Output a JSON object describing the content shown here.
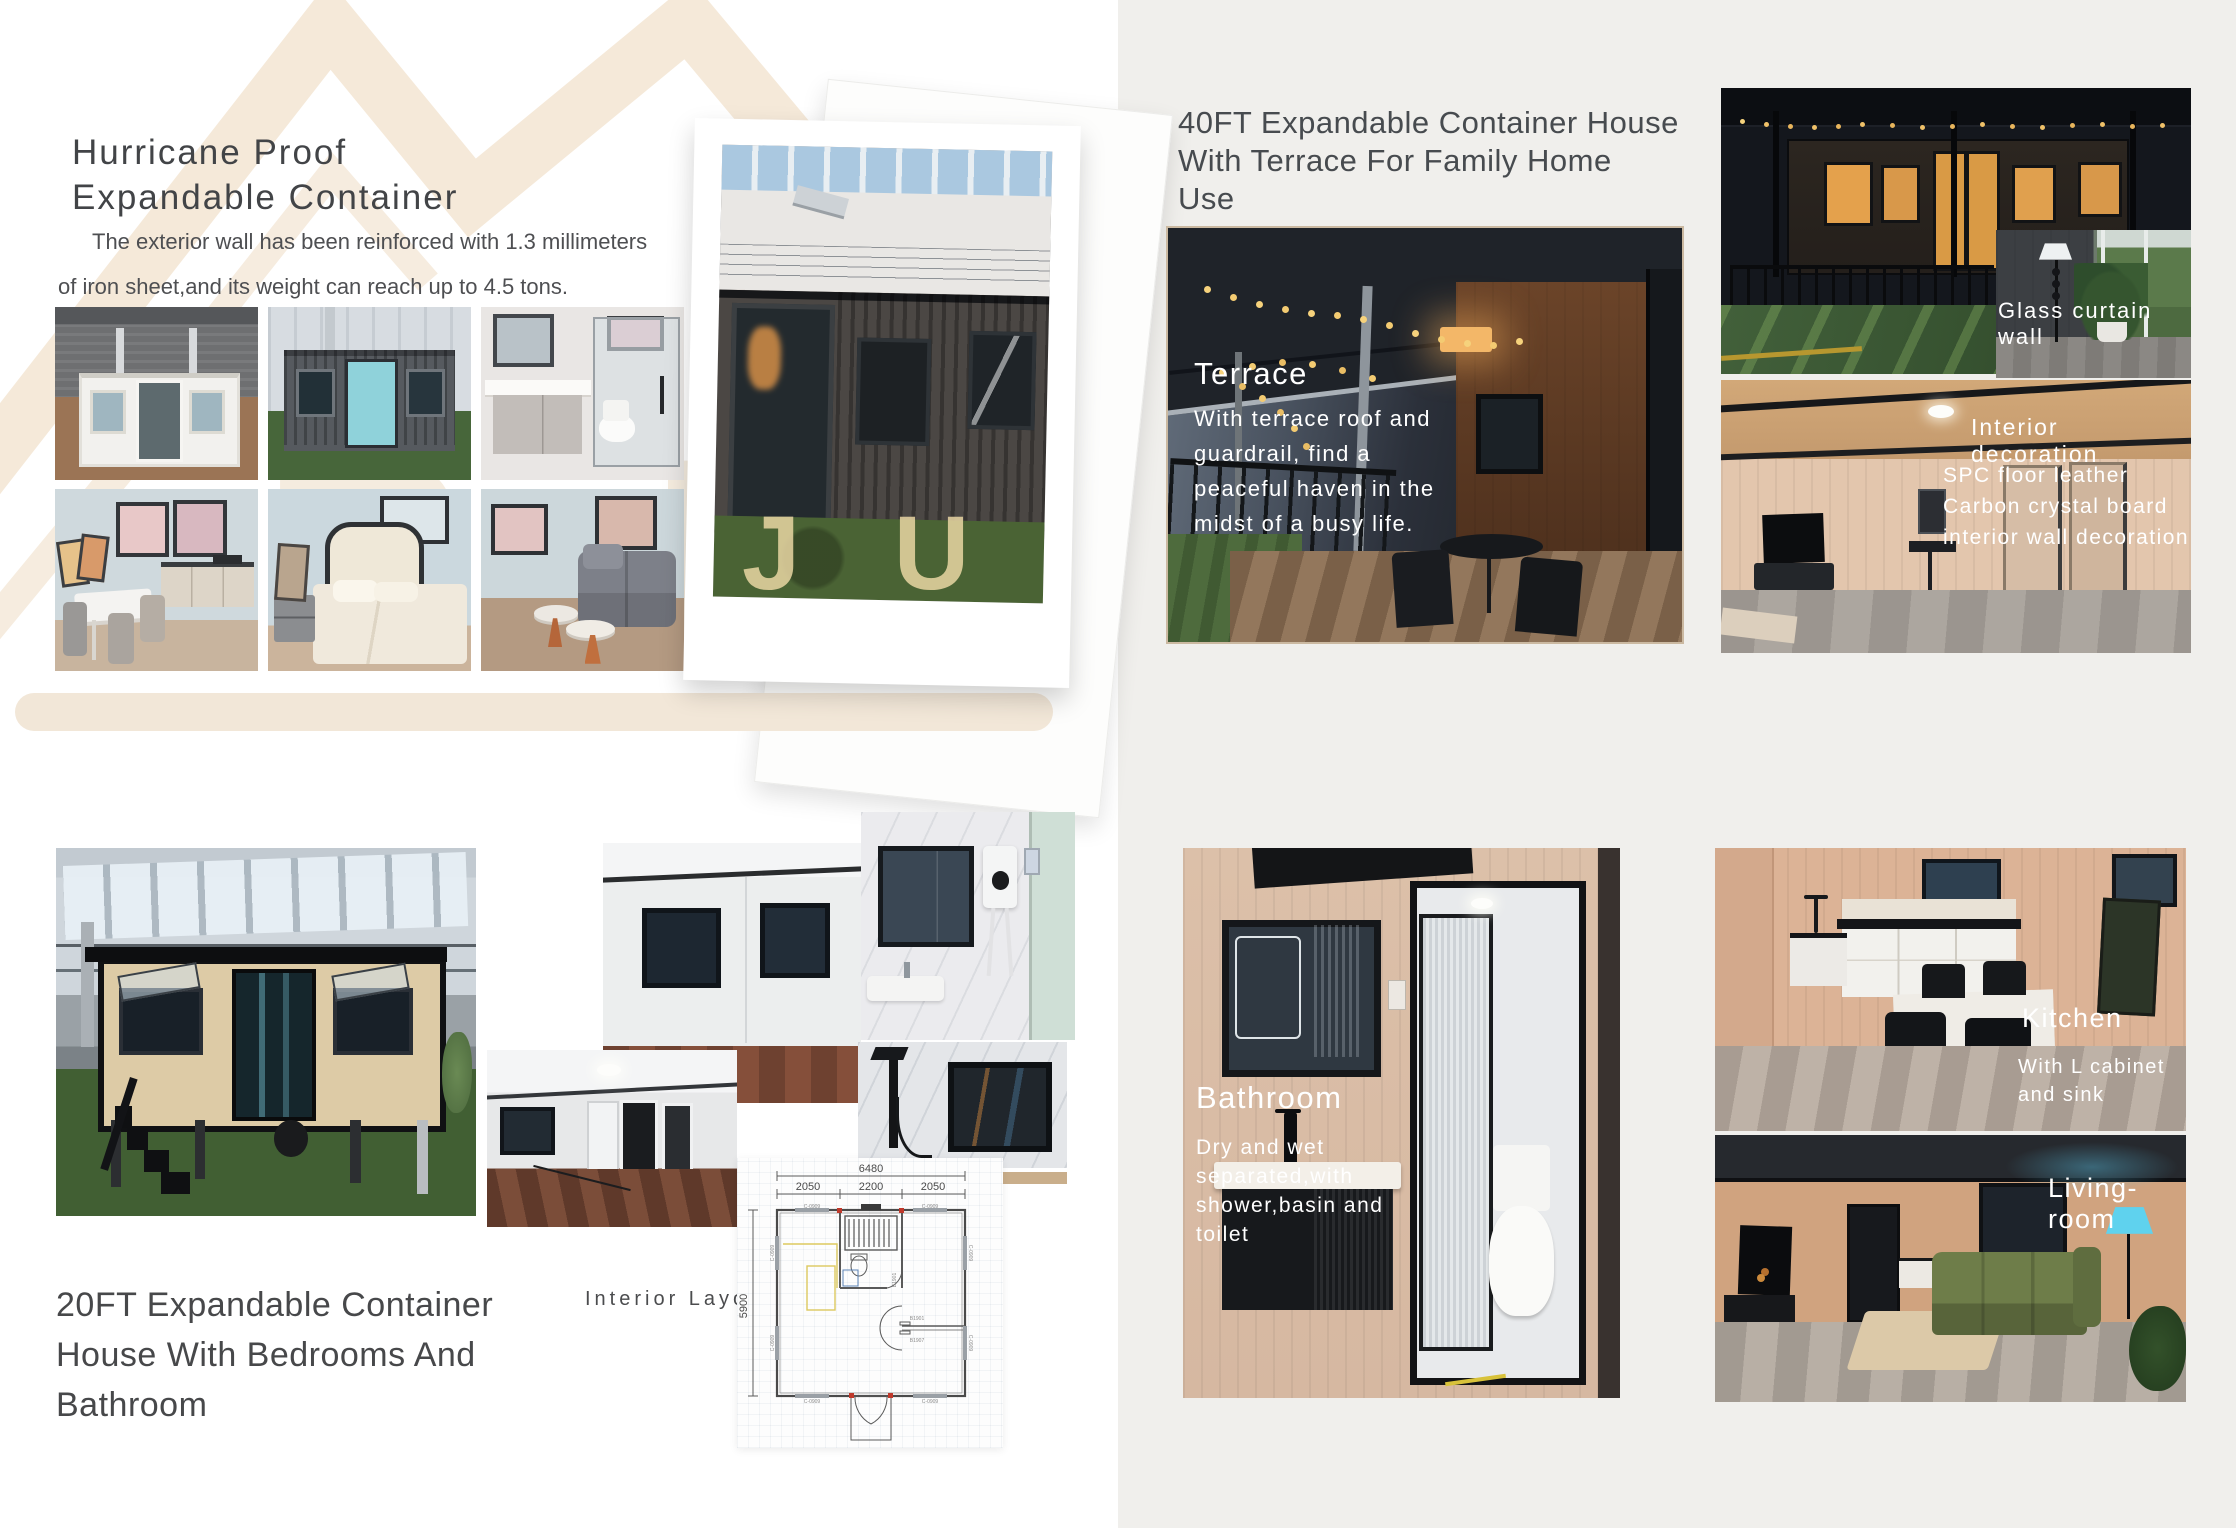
{
  "brand": {
    "watermark_back": "B U",
    "watermark_front": "J U"
  },
  "left_page": {
    "title": [
      "Hurricane Proof",
      "Expandable Container"
    ],
    "description": [
      "The exterior wall has been reinforced with 1.3 millimeters",
      "of iron sheet,and its weight can reach up to 4.5 tons."
    ],
    "product2": {
      "title": [
        "20FT Expandable Container",
        "House With Bedrooms And",
        "Bathroom"
      ],
      "layout_label": "Interior Layout",
      "floor_plan": {
        "overall_width_mm": "6480",
        "left_module_mm": "2050",
        "center_module_mm": "2200",
        "right_module_mm": "2050",
        "overall_depth_mm": "5900",
        "window_code": "C-0909",
        "door_code_top": "B1901",
        "door_code_bottom": "B1907"
      }
    }
  },
  "right_page": {
    "product_title": [
      "40FT Expandable Container House",
      "With Terrace For Family Home",
      "Use"
    ],
    "terrace": {
      "heading": "Terrace",
      "lines": [
        "With terrace roof and",
        "guardrail,  find a",
        "peaceful haven in the",
        "midst of a busy life."
      ]
    },
    "glass_wall_label": "Glass curtain wall",
    "interior": {
      "heading": "Interior decoration",
      "lines": [
        "SPC floor leather",
        "Carbon crystal board",
        "interior wall decoration"
      ]
    },
    "bathroom": {
      "heading": "Bathroom",
      "lines": [
        "Dry and wet",
        "separated,with",
        "shower,basin and",
        "toilet"
      ]
    },
    "kitchen": {
      "heading": "Kitchen",
      "lines": [
        "With L cabinet",
        "and sink"
      ]
    },
    "living_label": "Living-room"
  },
  "colors": {
    "accent_beige": "#f2e7d8",
    "page_gray": "#f0efec",
    "text_dark": "#45474a",
    "photo_text": "#ffffff"
  }
}
